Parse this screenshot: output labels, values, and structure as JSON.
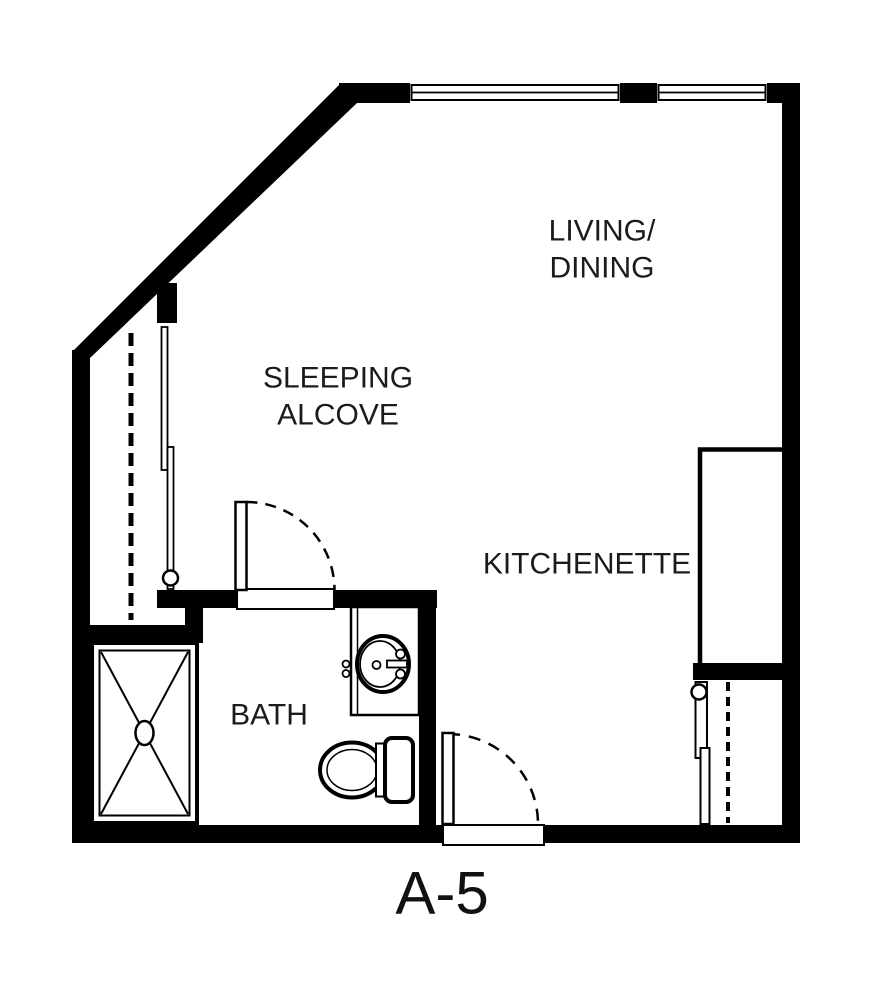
{
  "unit_label": "A-5",
  "colors": {
    "wall": "#000000",
    "text": "#1b1b1b",
    "background": "#ffffff"
  },
  "rooms": {
    "living_dining": {
      "line1": "LIVING/",
      "line2": "DINING"
    },
    "sleeping_alcove": {
      "line1": "SLEEPING",
      "line2": "ALCOVE"
    },
    "kitchenette": {
      "label": "KITCHENETTE"
    },
    "bath": {
      "label": "BATH"
    }
  },
  "fixtures": {
    "shower": "shower-pan-icon",
    "vanity_sink": "bathroom-sink-icon",
    "toilet": "toilet-icon",
    "left_closet": "sliding-door-closet-icon",
    "right_closet": "sliding-door-closet-icon",
    "kitchen_counter": "kitchenette-counter-icon",
    "bath_door": "door-swing-icon",
    "entry_door": "door-swing-icon",
    "window_top_left": "window-icon",
    "window_top_right": "window-icon"
  }
}
